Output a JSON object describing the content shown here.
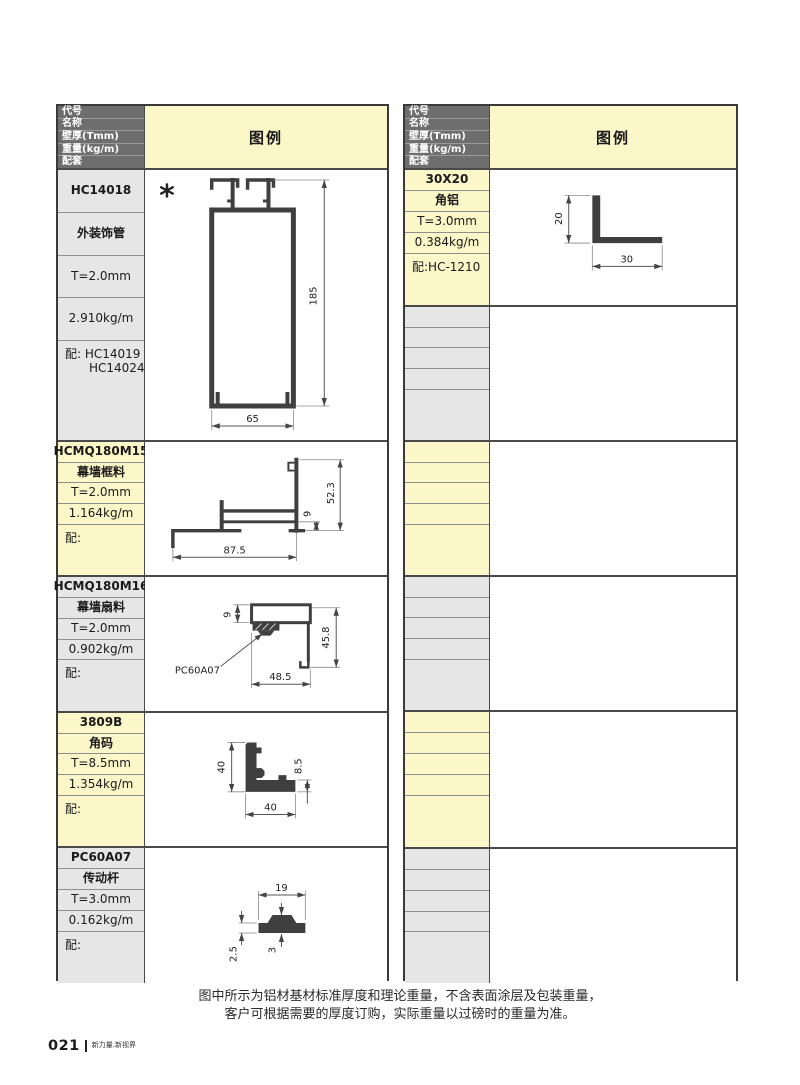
{
  "colors": {
    "header_bg": "#6e6e6e",
    "yellow": "#fbf7c9",
    "gray": "#e6e6e6",
    "profile": "#3f3f3f",
    "dim": "#555555",
    "border": "#3a3a3a",
    "text": "#1a1a1a"
  },
  "header_labels": {
    "code": "代号",
    "name": "名称",
    "thickness": "壁厚(Tmm)",
    "weight": "重量(kg/m)",
    "accessory": "配套",
    "legend": "图例"
  },
  "left_table": {
    "sections": [
      {
        "code": "HC14018",
        "name": "外装饰管",
        "thickness": "T=2.0mm",
        "weight": "2.910kg/m",
        "accessory_line1": "配: HC14019",
        "accessory_line2": "HC14024",
        "marker": "*",
        "dims": {
          "height": "185",
          "width": "65"
        }
      },
      {
        "code": "HCMQ180M15",
        "name": "幕墙框料",
        "thickness": "T=2.0mm",
        "weight": "1.164kg/m",
        "accessory_line1": "配:",
        "dims": {
          "width": "87.5",
          "height": "52.3",
          "gap": "9"
        }
      },
      {
        "code": "HCMQ180M16",
        "name": "幕墙扇料",
        "thickness": "T=2.0mm",
        "weight": "0.902kg/m",
        "accessory_line1": "配:",
        "dims": {
          "tube": "9",
          "height": "45.8",
          "width": "48.5",
          "callout": "PC60A07"
        }
      },
      {
        "code": "3809B",
        "name": "角码",
        "thickness": "T=8.5mm",
        "weight": "1.354kg/m",
        "accessory_line1": "配:",
        "dims": {
          "v": "40",
          "h": "40",
          "t": "8.5"
        }
      },
      {
        "code": "PC60A07",
        "name": "传动杆",
        "thickness": "T=3.0mm",
        "weight": "0.162kg/m",
        "accessory_line1": "配:",
        "dims": {
          "w": "19",
          "t": "2.5",
          "mid": "3"
        }
      }
    ]
  },
  "right_table": {
    "sections": [
      {
        "code": "30X20",
        "name": "角铝",
        "thickness": "T=3.0mm",
        "weight": "0.384kg/m",
        "accessory_line1": "配:HC-1210",
        "dims": {
          "v": "20",
          "h": "30"
        }
      }
    ]
  },
  "note": {
    "line1": "图中所示为铝材基材标准厚度和理论重量，不含表面涂层及包装重量，",
    "line2": "客户可根据需要的厚度订购，实际重量以过磅时的重量为准。"
  },
  "footer": {
    "page_number": "021",
    "brand": "新力量.新视界"
  }
}
